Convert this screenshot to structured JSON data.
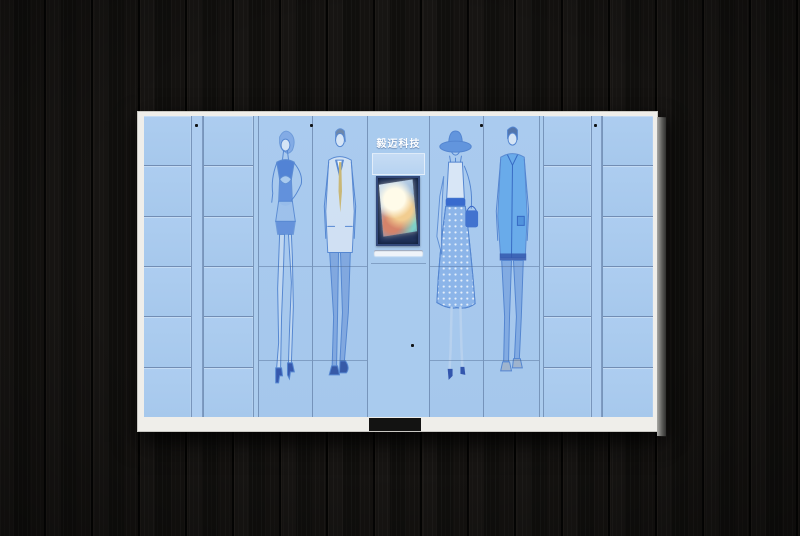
{
  "scene": {
    "description": "product photograph of a smart clothing storage locker cabinet mounted on a dark wood plank wall",
    "wall": {
      "material": "black wood planks, vertical grain",
      "color": "#12100f"
    },
    "colors": {
      "cabinet_body": "#a9cbee",
      "cabinet_frame": "#efeeea",
      "panel_lines": "#5a7ba8",
      "screen_bezel": "#20325a",
      "lock_dot": "#101418",
      "base_notch": "#131312"
    }
  },
  "cabinet": {
    "brand_sign": {
      "text": "毅迈科技",
      "text_color": "#ffffff"
    },
    "console": {
      "parts": [
        "brand-sign",
        "sign-panel",
        "kiosk-screen (powered on, warm colorful content)",
        "tray-slot",
        "service-door",
        "lock-dot"
      ]
    },
    "small_lockers": {
      "left_columns": 2,
      "right_columns": 2,
      "rows_per_column": 6
    },
    "figure_doors": [
      {
        "id": "woman-dress",
        "art": "blue sketch of woman in sleeveless dress, hand on hip, high heels"
      },
      {
        "id": "man-suit",
        "art": "blue sketch of man in light suit with yellow tie"
      },
      {
        "id": "woman-hat",
        "art": "blue sketch of woman in wide-brim hat, polka-dot skirt, carrying handbag"
      },
      {
        "id": "man-jacket",
        "art": "blue sketch of man in blue jacket and jeans"
      }
    ],
    "lock_dots_count": 5
  }
}
